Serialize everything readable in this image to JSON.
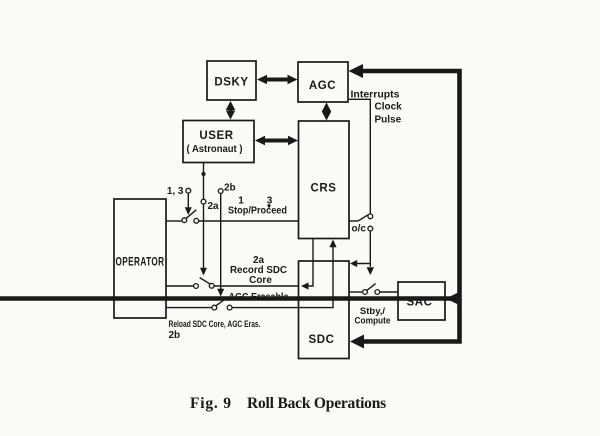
{
  "colors": {
    "ink": "#191919",
    "paper": "#fafaf8"
  },
  "diagram": {
    "boxes": {
      "dsky": "DSKY",
      "agc": "AGC",
      "user1": "USER",
      "user2": "( Astronaut )",
      "crs": "CRS",
      "operator": "OPERATOR",
      "sdc": "SDC",
      "sac": "SAC"
    },
    "agc_line": {
      "interrupts": "Interrupts",
      "clock": "Clock",
      "pulse": "Pulse"
    },
    "switches": {
      "s13": "1, 3",
      "s2a": "2a",
      "s2b": "2b",
      "num1": "1",
      "num3": "3",
      "stop_proceed": "Stop/Proceed",
      "oc": "o/c",
      "stby": "Stby,/",
      "compute": "Compute"
    },
    "record": {
      "tag": "2a",
      "line1": "Record SDC",
      "line2": "Core",
      "line3": "AGC Erasable"
    },
    "reload": {
      "line1": "Reload SDC Core, AGC Eras.",
      "tag": "2b"
    },
    "caption": {
      "fig": "Fig. 9",
      "title": "Roll Back Operations"
    }
  }
}
